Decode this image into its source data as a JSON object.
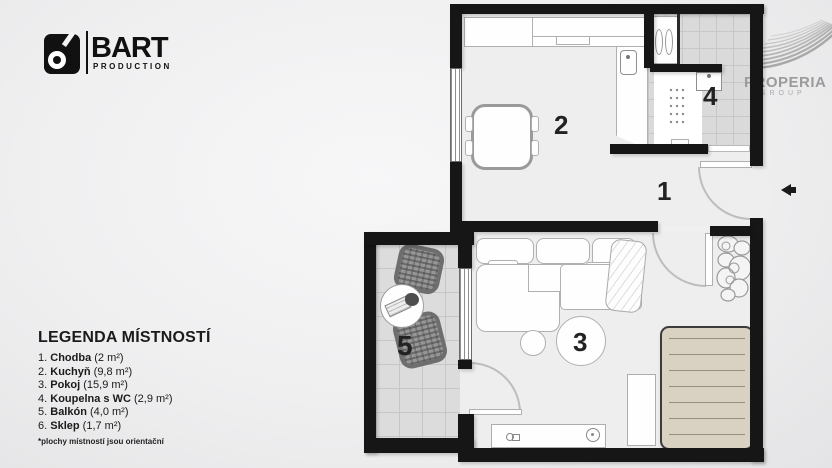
{
  "branding": {
    "bart": {
      "name": "BART",
      "subtitle": "PRODUCTION"
    },
    "properia": {
      "name": "PROPERIA",
      "subtitle": "GROUP"
    }
  },
  "legend": {
    "title": "LEGENDA MÍSTNOSTÍ",
    "footnote": "*plochy místností jsou orientační"
  },
  "rooms": [
    {
      "n": "1",
      "num": "1.",
      "name": "Chodba",
      "area": "(2 m²)"
    },
    {
      "n": "2",
      "num": "2.",
      "name": "Kuchyň",
      "area": "(9,8 m²)"
    },
    {
      "n": "3",
      "num": "3.",
      "name": "Pokoj",
      "area": "(15,9 m²)"
    },
    {
      "n": "4",
      "num": "4.",
      "name": "Koupelna s WC",
      "area": "(2,9 m²)"
    },
    {
      "n": "5",
      "num": "5.",
      "name": "Balkón",
      "area": "(4,0 m²)"
    },
    {
      "n": "6",
      "num": "6.",
      "name": "Sklep",
      "area": "(1,7 m²)"
    }
  ],
  "colors": {
    "wall": "#161616",
    "floor": "#eeeeef",
    "balcony_tile": "#dcdcdd",
    "bath_tile": "#dadadb",
    "bed": "#d9d2c3",
    "logo_gray": "#9b9b9b"
  },
  "icons": {
    "bart_logo": "camera-icon",
    "properia_logo": "wave-icon",
    "entrance": "arrow-left-icon"
  }
}
